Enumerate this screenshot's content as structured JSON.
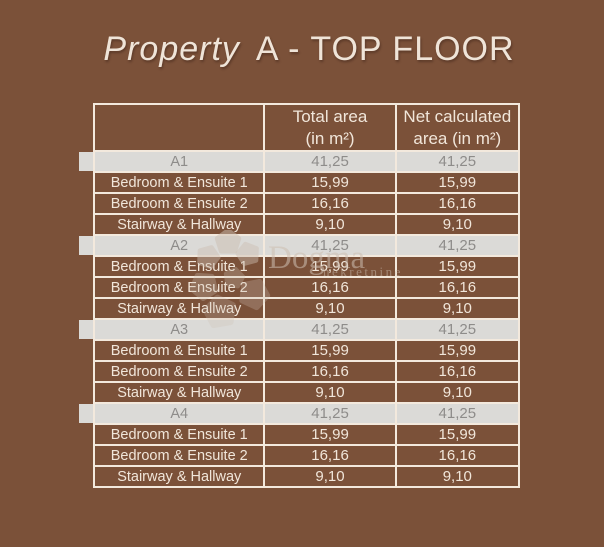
{
  "title": {
    "property": "Property",
    "floor": "A - TOP FLOOR"
  },
  "table": {
    "header": {
      "col1": "",
      "col2_line1": "Total area",
      "col2_line2": "(in m²)",
      "col3_line1": "Net calculated",
      "col3_line2": "area (in m²)"
    },
    "rows": [
      {
        "type": "section",
        "cells": [
          "A1",
          "41,25",
          "41,25"
        ]
      },
      {
        "type": "item",
        "cells": [
          "Bedroom & Ensuite 1",
          "15,99",
          "15,99"
        ]
      },
      {
        "type": "item",
        "cells": [
          "Bedroom & Ensuite 2",
          "16,16",
          "16,16"
        ]
      },
      {
        "type": "item",
        "cells": [
          "Stairway & Hallway",
          "9,10",
          "9,10"
        ]
      },
      {
        "type": "section",
        "cells": [
          "A2",
          "41,25",
          "41,25"
        ]
      },
      {
        "type": "item",
        "cells": [
          "Bedroom & Ensuite 1",
          "15,99",
          "15,99"
        ]
      },
      {
        "type": "item",
        "cells": [
          "Bedroom & Ensuite 2",
          "16,16",
          "16,16"
        ]
      },
      {
        "type": "item",
        "cells": [
          "Stairway & Hallway",
          "9,10",
          "9,10"
        ]
      },
      {
        "type": "section",
        "cells": [
          "A3",
          "41,25",
          "41,25"
        ]
      },
      {
        "type": "item",
        "cells": [
          "Bedroom & Ensuite 1",
          "15,99",
          "15,99"
        ]
      },
      {
        "type": "item",
        "cells": [
          "Bedroom & Ensuite 2",
          "16,16",
          "16,16"
        ]
      },
      {
        "type": "item",
        "cells": [
          "Stairway & Hallway",
          "9,10",
          "9,10"
        ]
      },
      {
        "type": "section",
        "cells": [
          "A4",
          "41,25",
          "41,25"
        ]
      },
      {
        "type": "item",
        "cells": [
          "Bedroom & Ensuite 1",
          "15,99",
          "15,99"
        ]
      },
      {
        "type": "item",
        "cells": [
          "Bedroom & Ensuite 2",
          "16,16",
          "16,16"
        ]
      },
      {
        "type": "item",
        "cells": [
          "Stairway & Hallway",
          "9,10",
          "9,10"
        ]
      }
    ]
  },
  "watermark": {
    "brand": "Dogma",
    "sub": "nekretnine",
    "logo_icon": "flower-petals-icon"
  },
  "colors": {
    "background": "#7B5139",
    "grid": "#F3E9DD",
    "section_row_bg": "#DBDAD7",
    "section_row_text": "#8E8C8A",
    "body_text": "#F1E6DA",
    "title_text": "#EFE4D8",
    "watermark": "#CDBFB2"
  }
}
